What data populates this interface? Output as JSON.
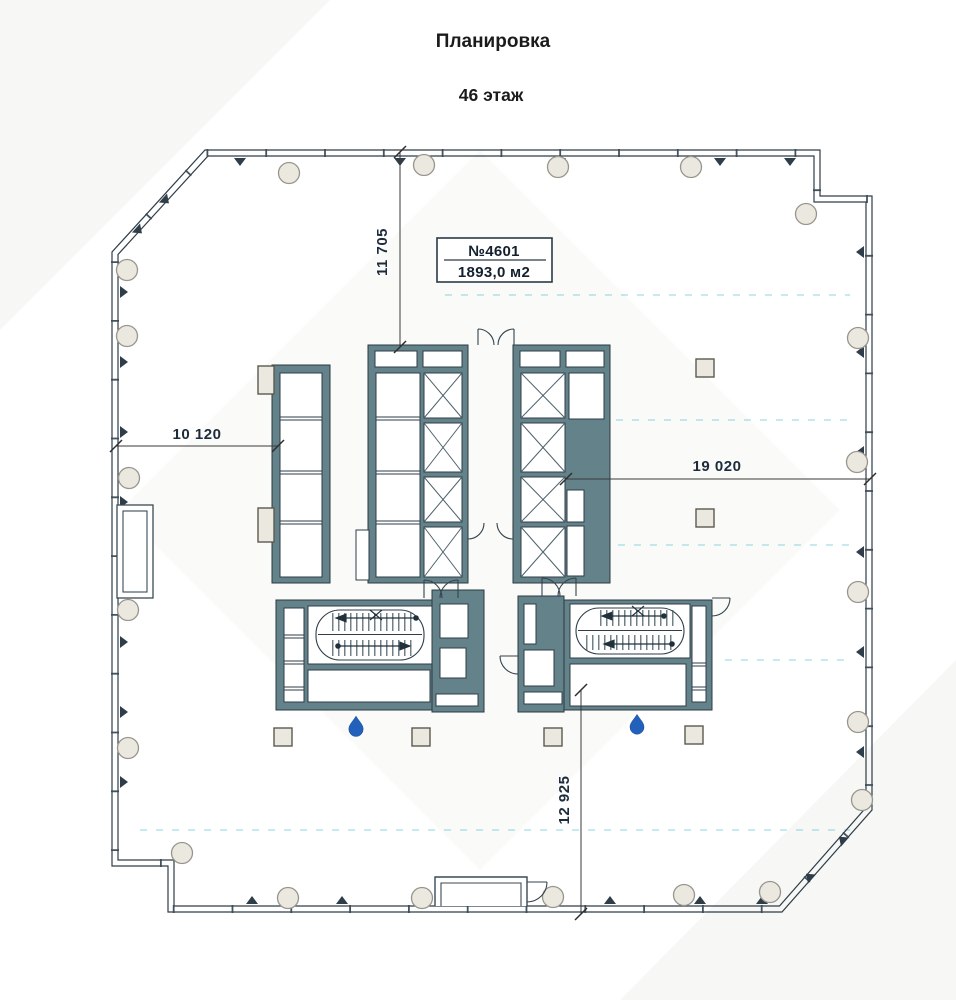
{
  "page": {
    "title": "Планировка",
    "subtitle": "46 этаж"
  },
  "unit_label": {
    "number": "№4601",
    "area": "1893,0 м2"
  },
  "dimensions": {
    "top_vertical": "11 705",
    "left_horizontal": "10 120",
    "right_horizontal": "19 020",
    "bottom_vertical": "12 925"
  },
  "icons": {
    "water_drop": "water-drop"
  },
  "colors": {
    "wall": "#64828a",
    "line": "#2e3d48",
    "dimension_text": "#1d2c3c",
    "grid_line": "#45c0cd",
    "water_drop": "#2160bb",
    "column_fill": "#ebe8df"
  }
}
